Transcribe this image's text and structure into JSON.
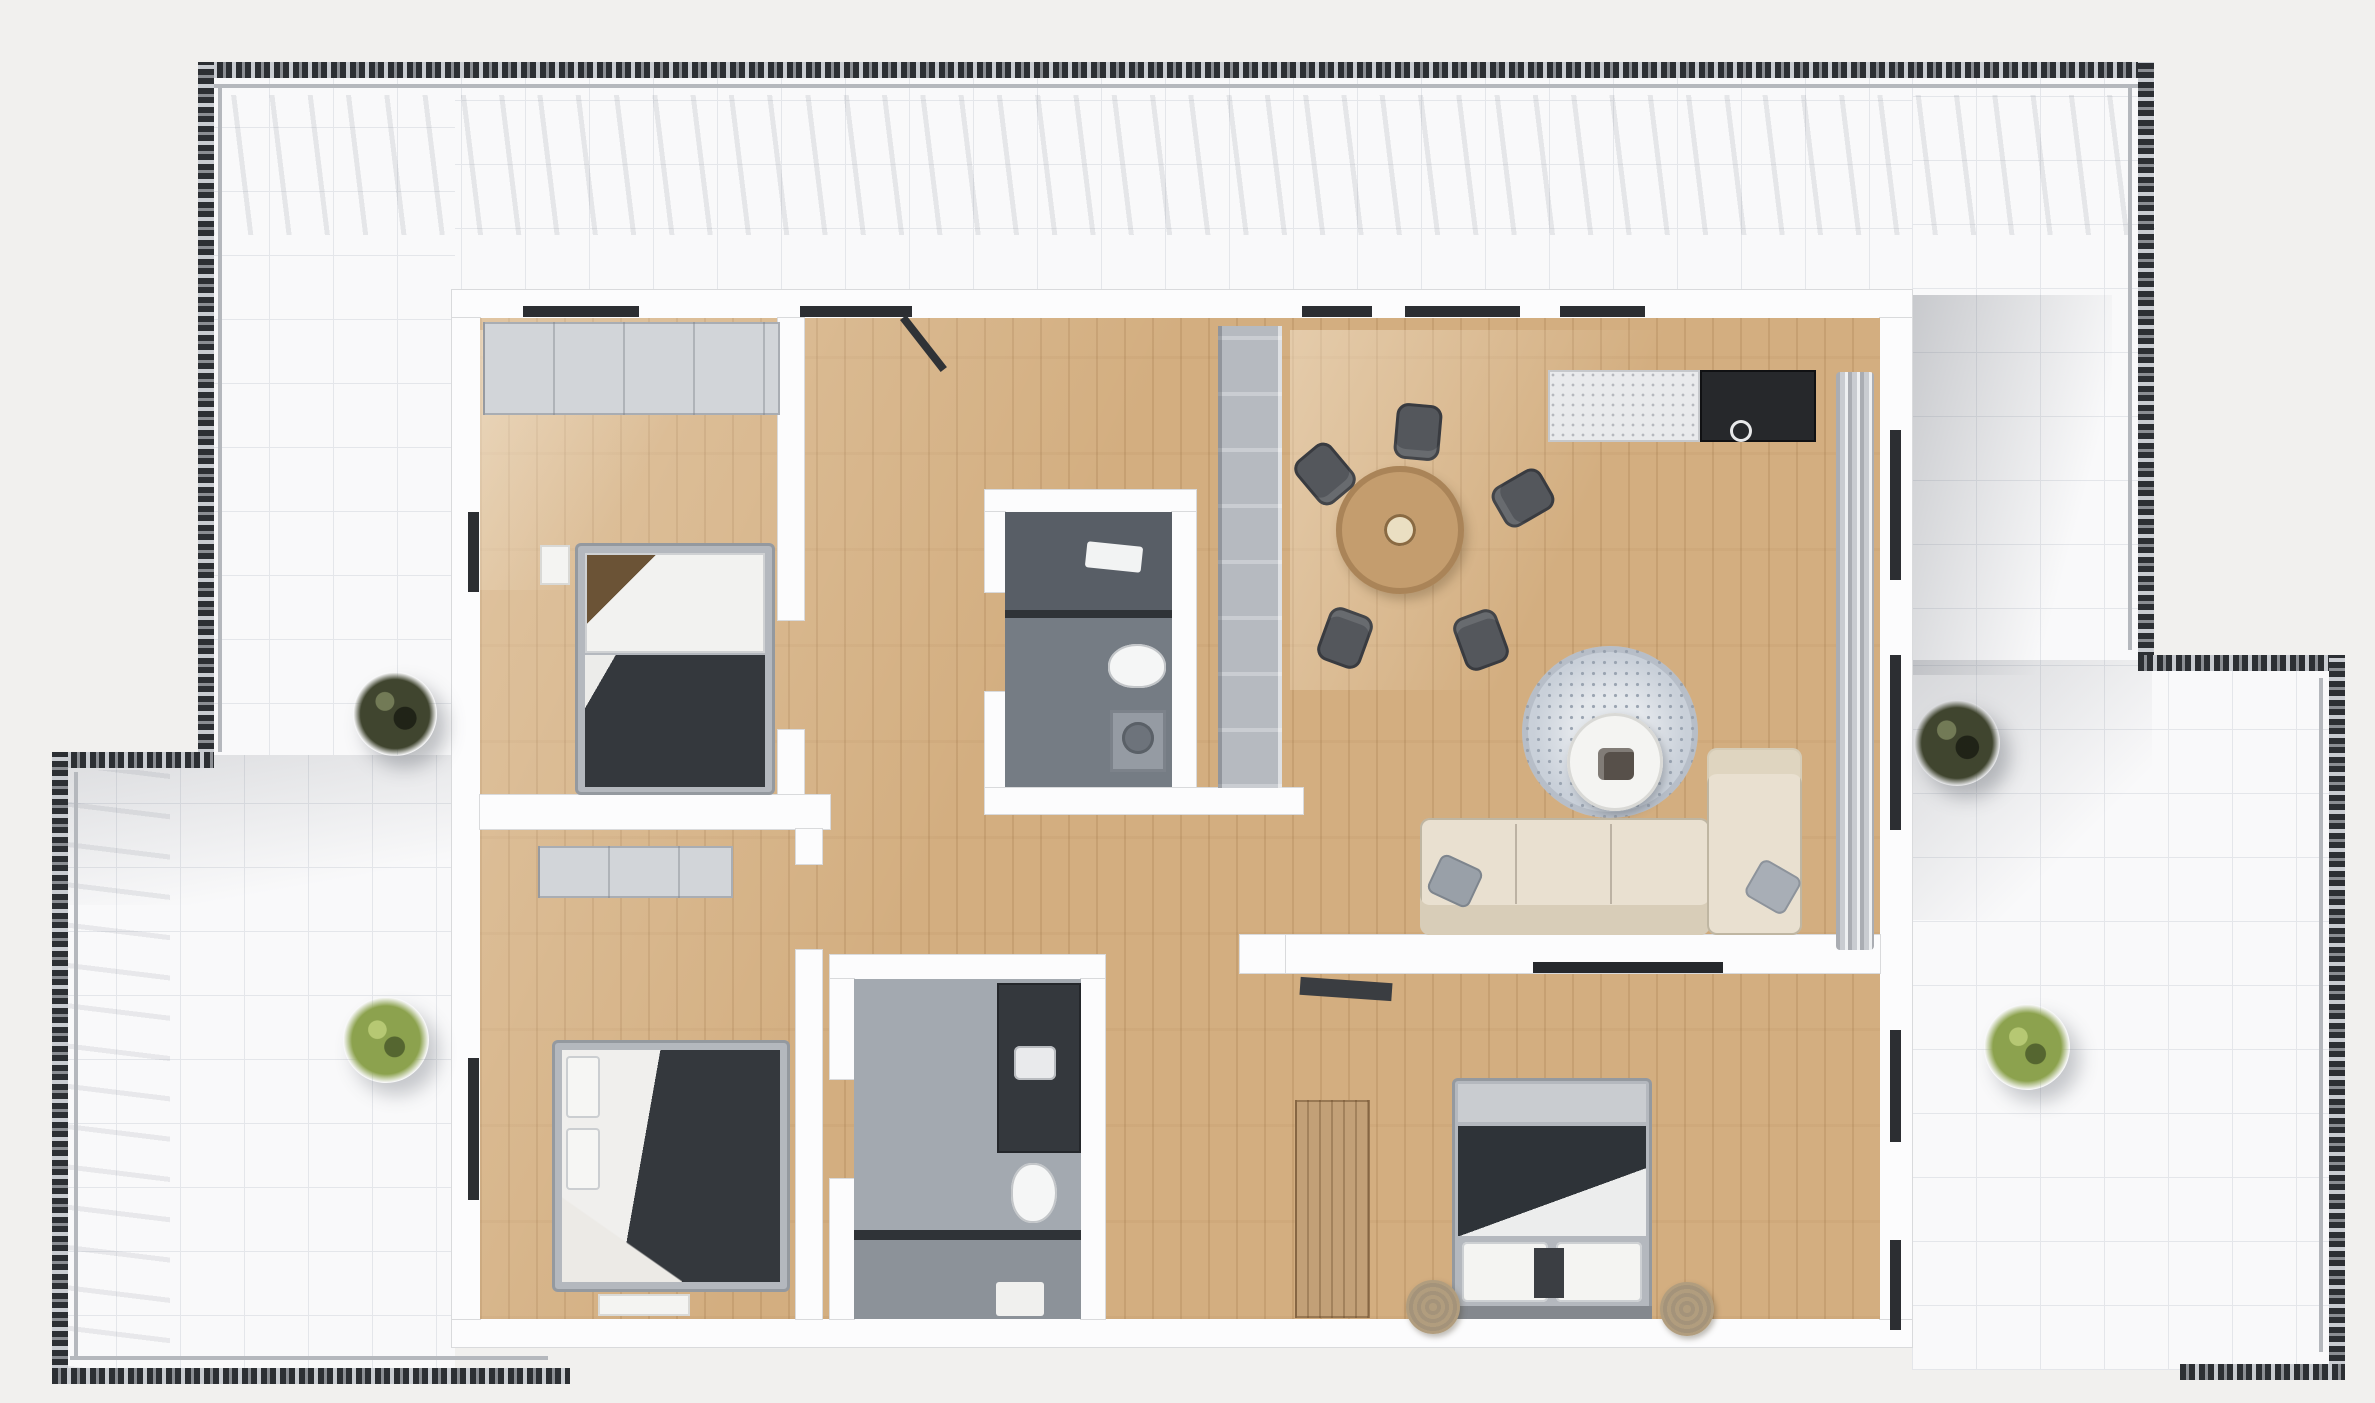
{
  "scene": {
    "title": "3D top-down apartment floor plan with wrap-around terrace"
  },
  "palette": {
    "bg": "#f1f0ee",
    "terrace": "#f9f9fa",
    "terraceLine": "#e4e6ea",
    "rail": "#2c2f33",
    "railLight": "#b5b8bd",
    "wall": "#fcfcfd",
    "wallEdge": "#d9dadc",
    "wood": "#d3ae80",
    "woodLine": "#b68c5c",
    "tile": "#a3a9b0",
    "tileDark": "#757c84",
    "fixture": "#34383d",
    "furnGray": "#d2d5d9",
    "bedFrame": "#b4b8be",
    "blanket": "#34383d",
    "sheet": "#f1f1ef",
    "sofa": "#e9e0d0",
    "sofaShade": "#d8cdb8",
    "rug": "#c9d0d9",
    "rugDot": "#9aa4b1",
    "tableWood": "#c49d6e",
    "tableEdge": "#aa8458",
    "plate": "#eadfc2",
    "chair": "#54575c",
    "marble": "#e9eaec",
    "counterDark": "#26282b",
    "curtain": "#c9ccd1",
    "curtainDark": "#aaadb3",
    "plantDark": "#40452f",
    "plantGreen": "#8ca24e",
    "glassCab": "#b6bac0",
    "windowDark": "#2c2e32",
    "woodWard": "#c2a077",
    "pouf": "#b19d7e",
    "navy": "#2e3338"
  },
  "rooms": [
    {
      "name": "Bedroom 1",
      "floor": "wood",
      "furniture": [
        "wardrobe",
        "double-bed",
        "nightstand"
      ]
    },
    {
      "name": "Bedroom 2",
      "floor": "wood",
      "furniture": [
        "dresser",
        "double-bed",
        "bench"
      ]
    },
    {
      "name": "Entry hallway",
      "floor": "wood",
      "furniture": [
        "entry-door",
        "tall-cabinet"
      ]
    },
    {
      "name": "Shower room",
      "floor": "tile",
      "furniture": [
        "shower",
        "towel",
        "toilet",
        "washing-machine"
      ]
    },
    {
      "name": "Bathroom",
      "floor": "tile",
      "furniture": [
        "vanity",
        "toilet",
        "shower",
        "bath-mat"
      ]
    },
    {
      "name": "Living room with kitchen and dining",
      "floor": "wood",
      "furniture": [
        "kitchen-counter",
        "cooktop",
        "dining-table",
        "dining-chairs",
        "area-rug",
        "coffee-table",
        "sofa",
        "chaise",
        "curtain",
        "media-console"
      ]
    },
    {
      "name": "Bedroom 3",
      "floor": "wood",
      "furniture": [
        "wardrobe",
        "double-bed",
        "foot-bench",
        "poufs"
      ]
    },
    {
      "name": "Wrap-around terrace",
      "floor": "tile",
      "furniture": [
        "plants",
        "railing"
      ]
    }
  ],
  "furniture": {
    "wardrobe1": "Wardrobe",
    "bed1": "Double bed",
    "nightstand1": "Nightstand",
    "dresser2": "Dresser",
    "bed2": "Double bed",
    "bench2": "Bedroom bench",
    "entryDoor": "Entry door",
    "hallCabinet": "Hallway cabinet",
    "shower": "Shower",
    "towel": "Towel",
    "wcToilet": "Toilet",
    "washer": "Washing machine",
    "vanity": "Vanity unit",
    "bathToilet": "Toilet",
    "showerDivider": "Shower glass divider",
    "bathMat": "Bath mat",
    "counter": "Kitchen counter",
    "cooktop": "Cooktop",
    "diningTable": "Dining table",
    "diningChair": "Dining chair",
    "rug": "Area rug",
    "coffeeTable": "Coffee table",
    "sofa": "Sofa",
    "chaise": "Chaise lounge",
    "throwPillow": "Throw pillow",
    "curtain": "Floor-length curtain",
    "mediaConsole": "Media console",
    "wardrobe3": "Wardrobe",
    "bed3": "Double bed",
    "footBench": "Foot bench",
    "pouf": "Pouf",
    "plant": "Potted plant",
    "railing": "Terrace railing",
    "window": "Window"
  },
  "counts": {
    "plants": 4,
    "dining_chairs": 5,
    "bedrooms": 3,
    "bathrooms": 2
  }
}
